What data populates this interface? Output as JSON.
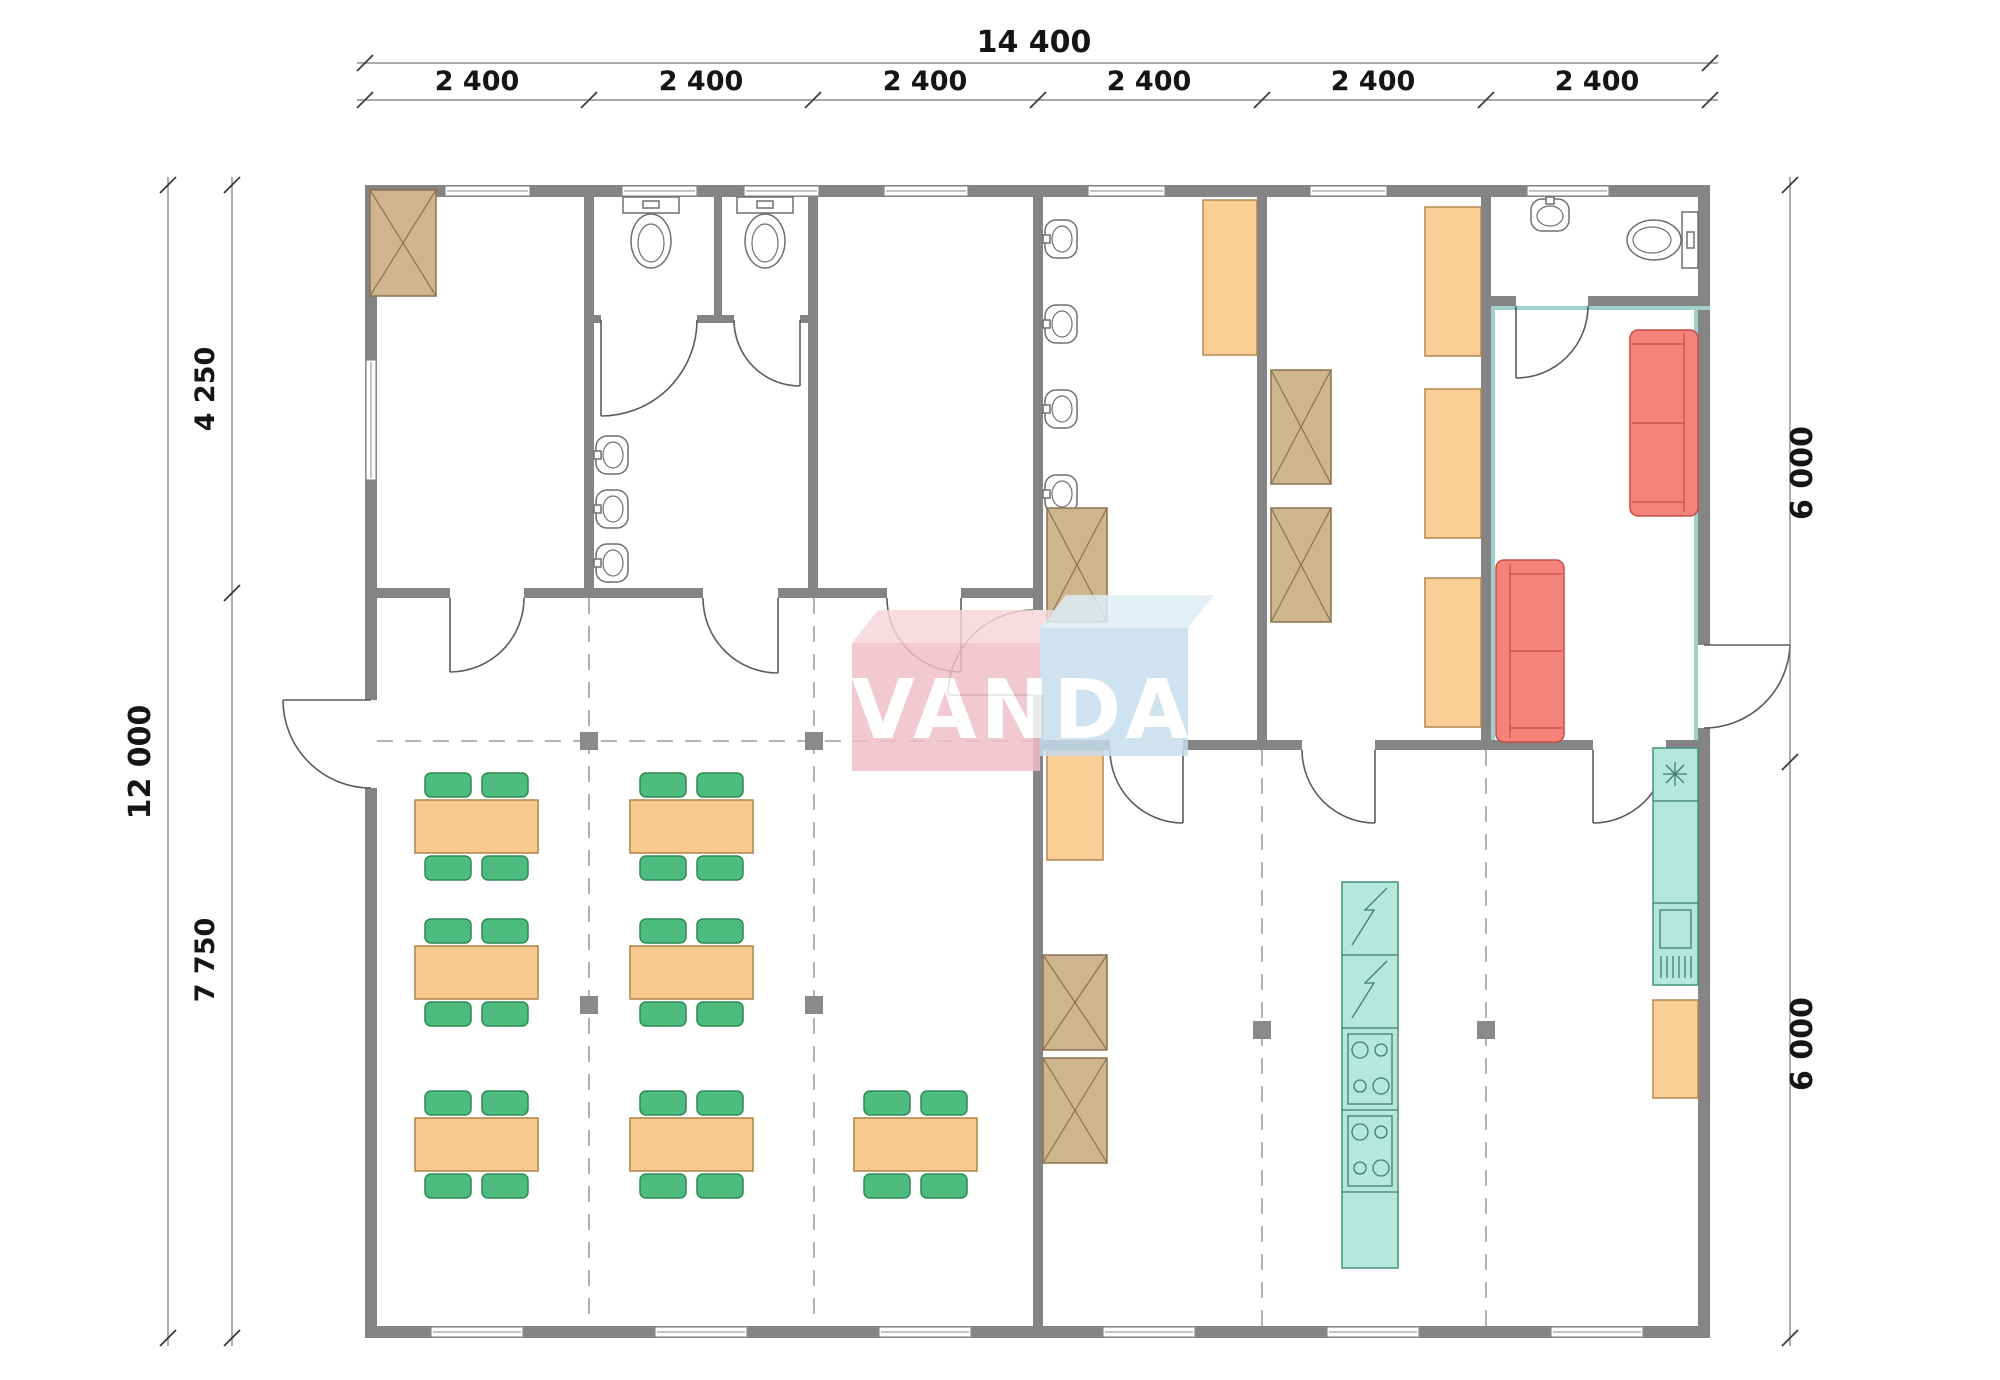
{
  "watermark": {
    "text": "VANDA"
  },
  "dimensions": {
    "top_total": "14 400",
    "top_segments": [
      "2 400",
      "2 400",
      "2 400",
      "2 400",
      "2 400",
      "2 400"
    ],
    "left_total": "12 000",
    "left_segments": [
      "4 250",
      "7 750"
    ],
    "right_segments": [
      "6 000",
      "6 000"
    ]
  },
  "colors": {
    "wall": "#848484",
    "table_top": "#f9c98e",
    "chair": "#4fbc7f",
    "wardrobe": "#cfb58d",
    "bed_cabinet": "#fbce96",
    "sofa": "#f4837b",
    "appliance": "#b5e7da",
    "column": "#8a8a8a",
    "dimension_text": "#151515",
    "watermark_pink": "#f0bec9",
    "watermark_blue": "#c6ddee"
  },
  "equipment": {
    "dining_tables": 7,
    "chairs": 28,
    "wardrobes": 6,
    "beds_or_cabinets": 6,
    "toilets": 4,
    "wash_basins": 8,
    "sofas": 2,
    "refrigerators": 2,
    "stoves": 2,
    "kitchen_sink_units": 1,
    "dishwashers": 1,
    "structural_columns": 6
  }
}
